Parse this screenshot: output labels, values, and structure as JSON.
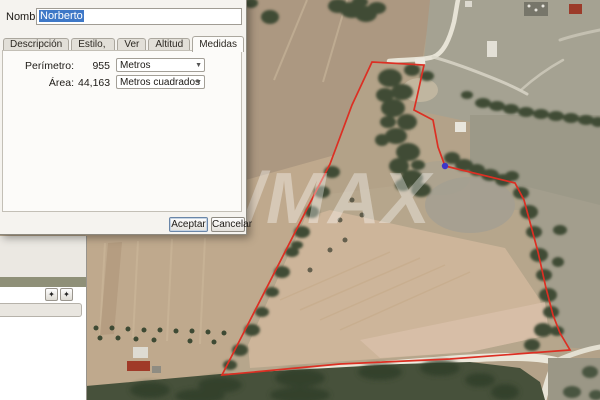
{
  "dialog": {
    "name_label": "Nombre:",
    "name_value": "Norberto",
    "tabs": [
      {
        "label": "Descripción"
      },
      {
        "label": "Estilo, color"
      },
      {
        "label": "Ver"
      },
      {
        "label": "Altitud"
      },
      {
        "label": "Medidas"
      }
    ],
    "fields": [
      {
        "label": "Perímetro:",
        "value": "955",
        "unit": "Metros"
      },
      {
        "label": "Área:",
        "value": "44,163",
        "unit": "Metros cuadrados"
      }
    ],
    "accept_label": "Aceptar",
    "cancel_label": "Cancelar"
  },
  "sidebar": {
    "buttons": [
      {
        "icon": "✦"
      },
      {
        "icon": "✦"
      }
    ]
  },
  "map": {
    "watermark": "RE/MAX",
    "parcel": {
      "perimeter": "955 Metros",
      "area": "44,163 Metros cuadrados",
      "outline_color": "#dc2f23",
      "marker_color": "#3d36c9"
    }
  }
}
